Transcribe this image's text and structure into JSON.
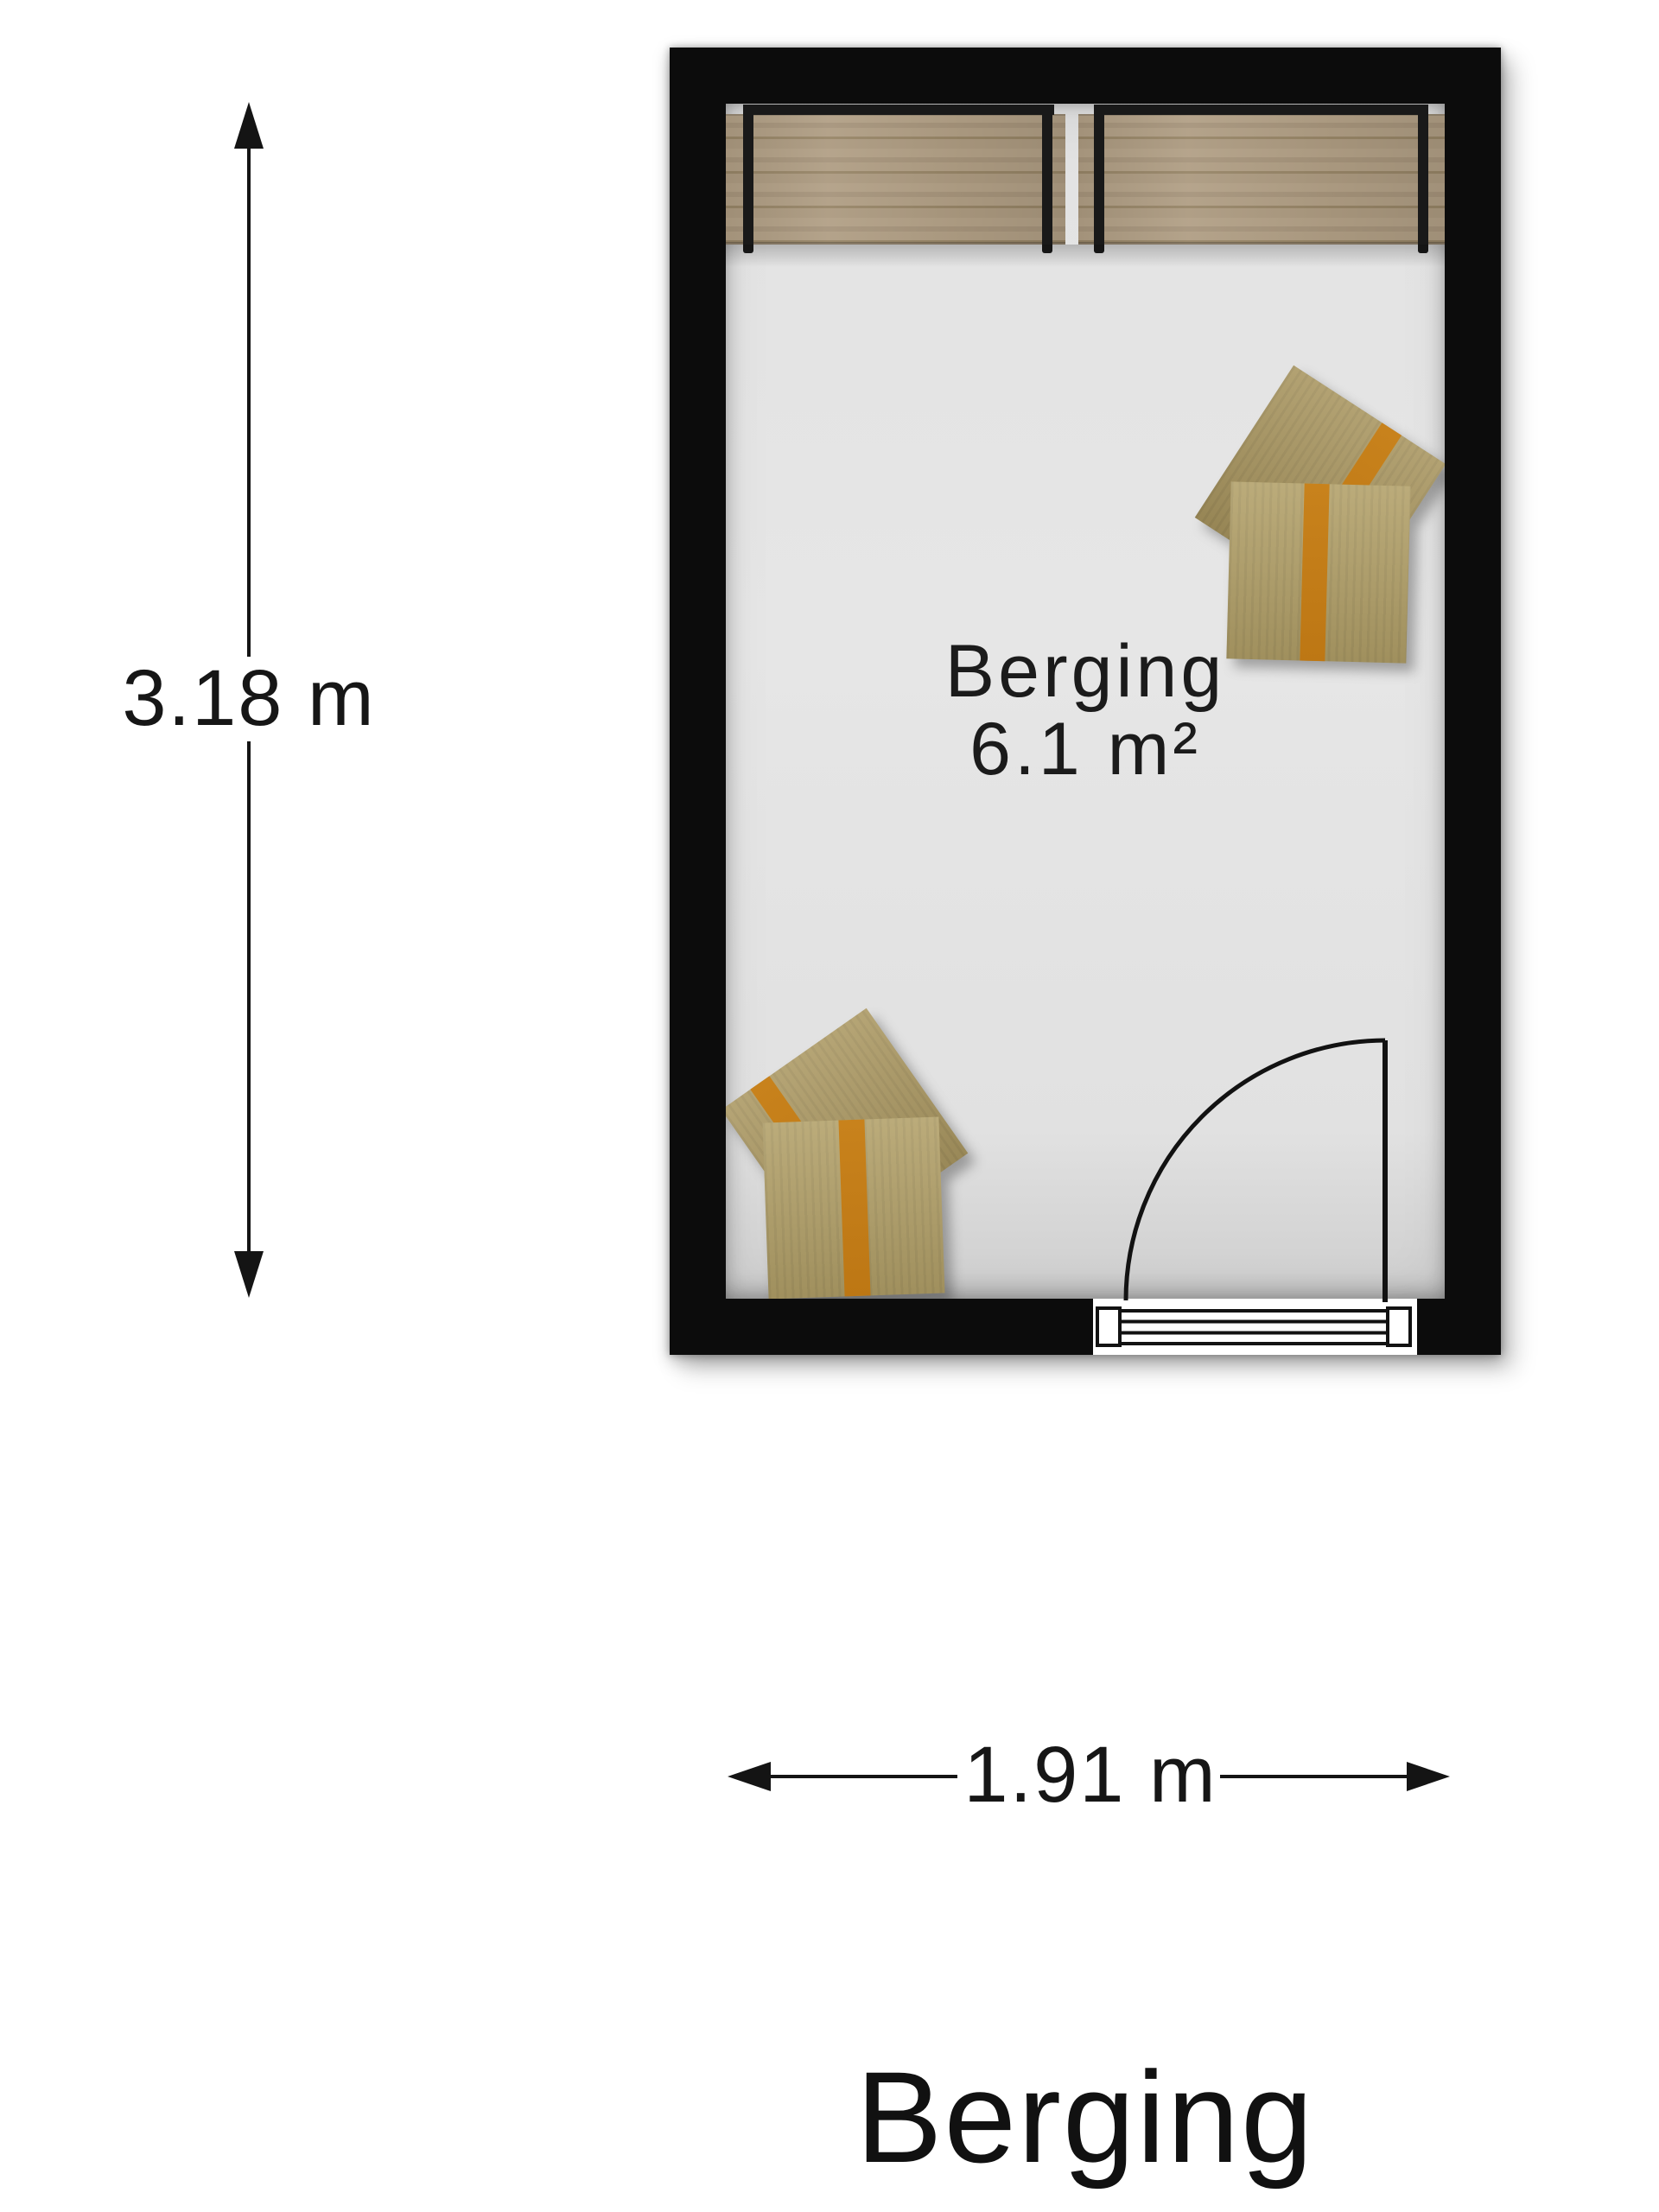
{
  "floorplan": {
    "title": "Berging",
    "room": {
      "name": "Berging",
      "area": "6.1 m²",
      "height_dim": "3.18 m",
      "width_dim": "1.91 m"
    },
    "colors": {
      "wall": "#0c0c0c",
      "floor": "#e3e3e3",
      "wood": "#ab9a81",
      "cardboard": "#b2a068",
      "cardboard_dark": "#a8955f",
      "tape": "#c8821c",
      "line": "#141414",
      "text": "#161616",
      "background": "#ffffff"
    }
  }
}
